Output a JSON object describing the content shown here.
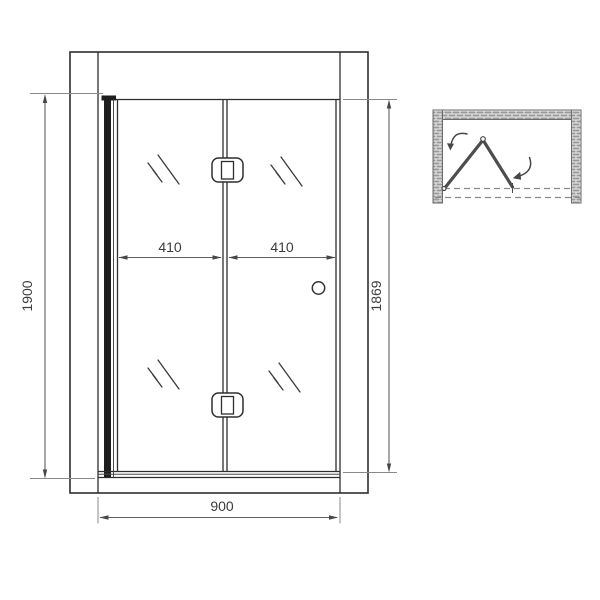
{
  "drawing": {
    "type": "technical-drawing",
    "views": [
      "front-elevation",
      "plan-top-view"
    ]
  },
  "dimensions": {
    "height_overall": "1900",
    "height_door": "1869",
    "panel_left": "410",
    "panel_right": "410",
    "width_overall": "900"
  },
  "colors": {
    "line": "#2e2e2e",
    "dimension_line": "#5f5f5f",
    "dimension_text": "#3c3c3c",
    "hatch": "#9a9a9a",
    "fold_panel": "#4d4d4d",
    "background": "#ffffff"
  }
}
